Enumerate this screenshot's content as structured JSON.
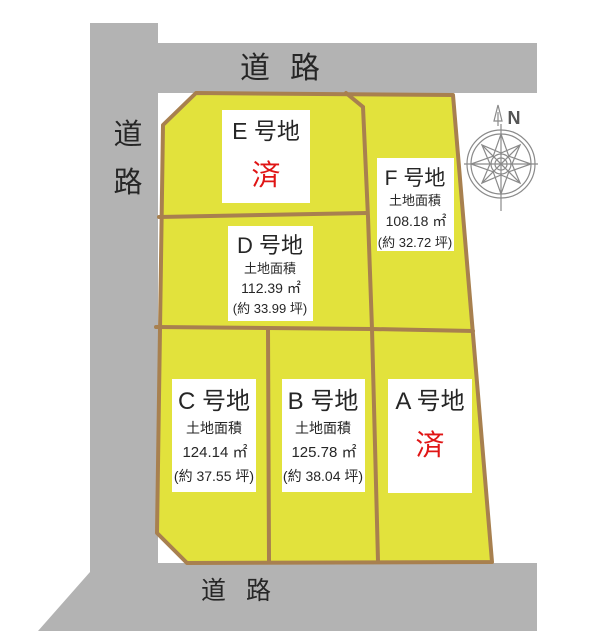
{
  "colors": {
    "road": "#b3b3b3",
    "parcel": "#e2e23c",
    "border": "#a8804f",
    "sold": "#e01515",
    "compass": "#8a8a8a"
  },
  "roads": {
    "top_label": "道路",
    "bottom_label": "道路",
    "left_label_top": "道",
    "left_label_bottom": "路"
  },
  "compass": {
    "north_label": "N"
  },
  "plots": [
    {
      "id": "E",
      "name": "E 号地",
      "status": "済"
    },
    {
      "id": "F",
      "name": "F 号地",
      "area_label": "土地面積",
      "area_sqm": "108.18 ㎡",
      "area_tsubo": "(約 32.72 坪)"
    },
    {
      "id": "D",
      "name": "D 号地",
      "area_label": "土地面積",
      "area_sqm": "112.39 ㎡",
      "area_tsubo": "(約 33.99 坪)"
    },
    {
      "id": "C",
      "name": "C 号地",
      "area_label": "土地面積",
      "area_sqm": "124.14 ㎡",
      "area_tsubo": "(約 37.55 坪)"
    },
    {
      "id": "B",
      "name": "B 号地",
      "area_label": "土地面積",
      "area_sqm": "125.78 ㎡",
      "area_tsubo": "(約 38.04 坪)"
    },
    {
      "id": "A",
      "name": "A 号地",
      "status": "済"
    }
  ]
}
